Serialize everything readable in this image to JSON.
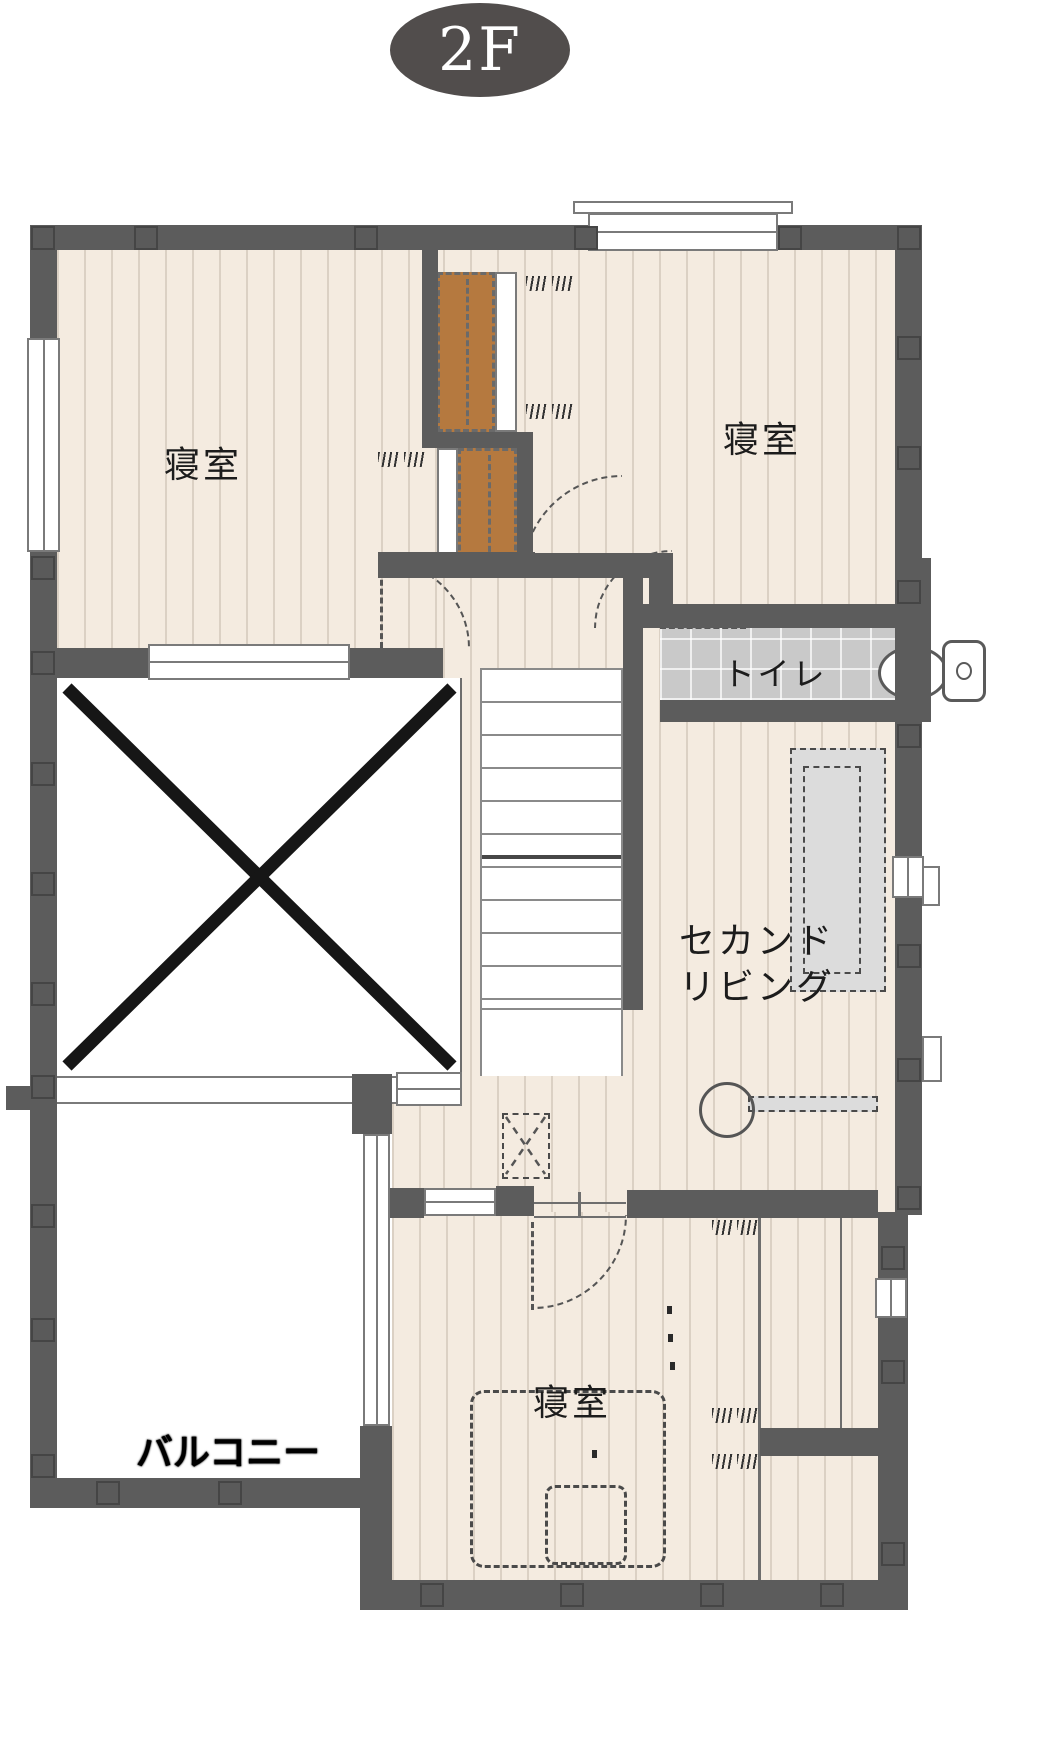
{
  "floor_badge": {
    "label": "2F",
    "bg": "#514d4c",
    "text_color": "#ffffff"
  },
  "rooms": {
    "bedroom_top_left": {
      "label": "寝室"
    },
    "bedroom_top_right": {
      "label": "寝室"
    },
    "toilet": {
      "label": "トイレ"
    },
    "second_living": {
      "label_line1": "セカンド",
      "label_line2": "リビング"
    },
    "bedroom_bottom": {
      "label": "寝室"
    },
    "balcony": {
      "label": "バルコニー"
    }
  },
  "colors": {
    "wall": "#5c5c5c",
    "floor_wood": "#f4ebe0",
    "toilet_tile": "#c9c9c9",
    "closet_wood": "#b5793f",
    "furniture_gray": "#dcdcdc",
    "symbol_line": "#555555",
    "void_cross": "#161616"
  }
}
